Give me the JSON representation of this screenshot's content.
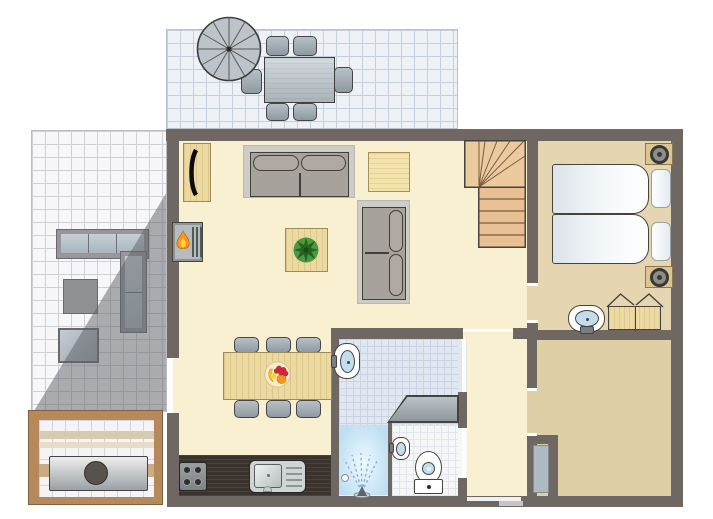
{
  "floorplan": {
    "type": "holiday-home-floor-plan",
    "rooms": [
      {
        "name": "top-terrace",
        "floor": "blue-grey-tiles",
        "furniture": [
          "parasol",
          "outdoor-dining-table",
          "six-outdoor-chairs"
        ]
      },
      {
        "name": "side-terrace",
        "floor": "white-tiles",
        "furniture": [
          "corner-lounge-sofa",
          "ottoman",
          "lounge-table"
        ],
        "overlay": "diagonal-shadow"
      },
      {
        "name": "sauna-cabin",
        "floor": "white-tiles",
        "furniture": [
          "bench-stripes",
          "hot-tub-with-round-opening"
        ]
      },
      {
        "name": "living-room",
        "floor": "cream",
        "furniture": [
          "tv-cabinet",
          "fireplace",
          "two-seat-sofa",
          "side-table",
          "coffee-table-with-plant",
          "second-sofa",
          "dining-table-with-fruit-bowl",
          "six-dining-chairs",
          "staircase"
        ]
      },
      {
        "name": "kitchen-strip",
        "floor": "dark-counter",
        "furniture": [
          "stove-four-burners",
          "kitchen-sink-with-drainer"
        ]
      },
      {
        "name": "bedroom",
        "floor": "tan",
        "furniture": [
          "single-bed",
          "single-bed",
          "nightstand-with-lamp",
          "nightstand-with-lamp",
          "washbasin",
          "wardrobe-open-doors"
        ]
      },
      {
        "name": "bathroom",
        "floor": "blue-grey-tiles",
        "furniture": [
          "washbasin",
          "shower-with-spray",
          "angled-partition",
          "floor-drain"
        ]
      },
      {
        "name": "toilet-room",
        "floor": "white-tiles",
        "furniture": [
          "toilet",
          "small-washbasin"
        ]
      },
      {
        "name": "hallway",
        "floor": "cream",
        "furniture": [
          "front-door"
        ]
      },
      {
        "name": "second-bedroom",
        "floor": "tan",
        "furniture": [
          "closet-nook",
          "grey-door-leaf"
        ]
      }
    ],
    "colors": {
      "wall": "#6f6761",
      "living_floor": "#f9efd1",
      "bedroom_floor": "#e5d5b0",
      "second_room_floor": "#decfa7",
      "terrace_tile": "#eef1f5",
      "side_terrace_tile": "#f7f7f9",
      "bath_tile": "#e1e7f0",
      "toilet_tile": "#f4f6f8",
      "wood": "#ecd9a0",
      "stairs_wood": "#eccaa0",
      "kitchen_counter": "#3a332d",
      "sauna_frame": "#b5895c",
      "shadow": "rgba(93,95,101,0.5)",
      "water_blue": "#c3ddee",
      "shower_blue": "#bedff2",
      "flame_orange": "#f59a1e",
      "plant_green": "#4a9a44",
      "grey_furniture": "#a8a29c"
    }
  }
}
